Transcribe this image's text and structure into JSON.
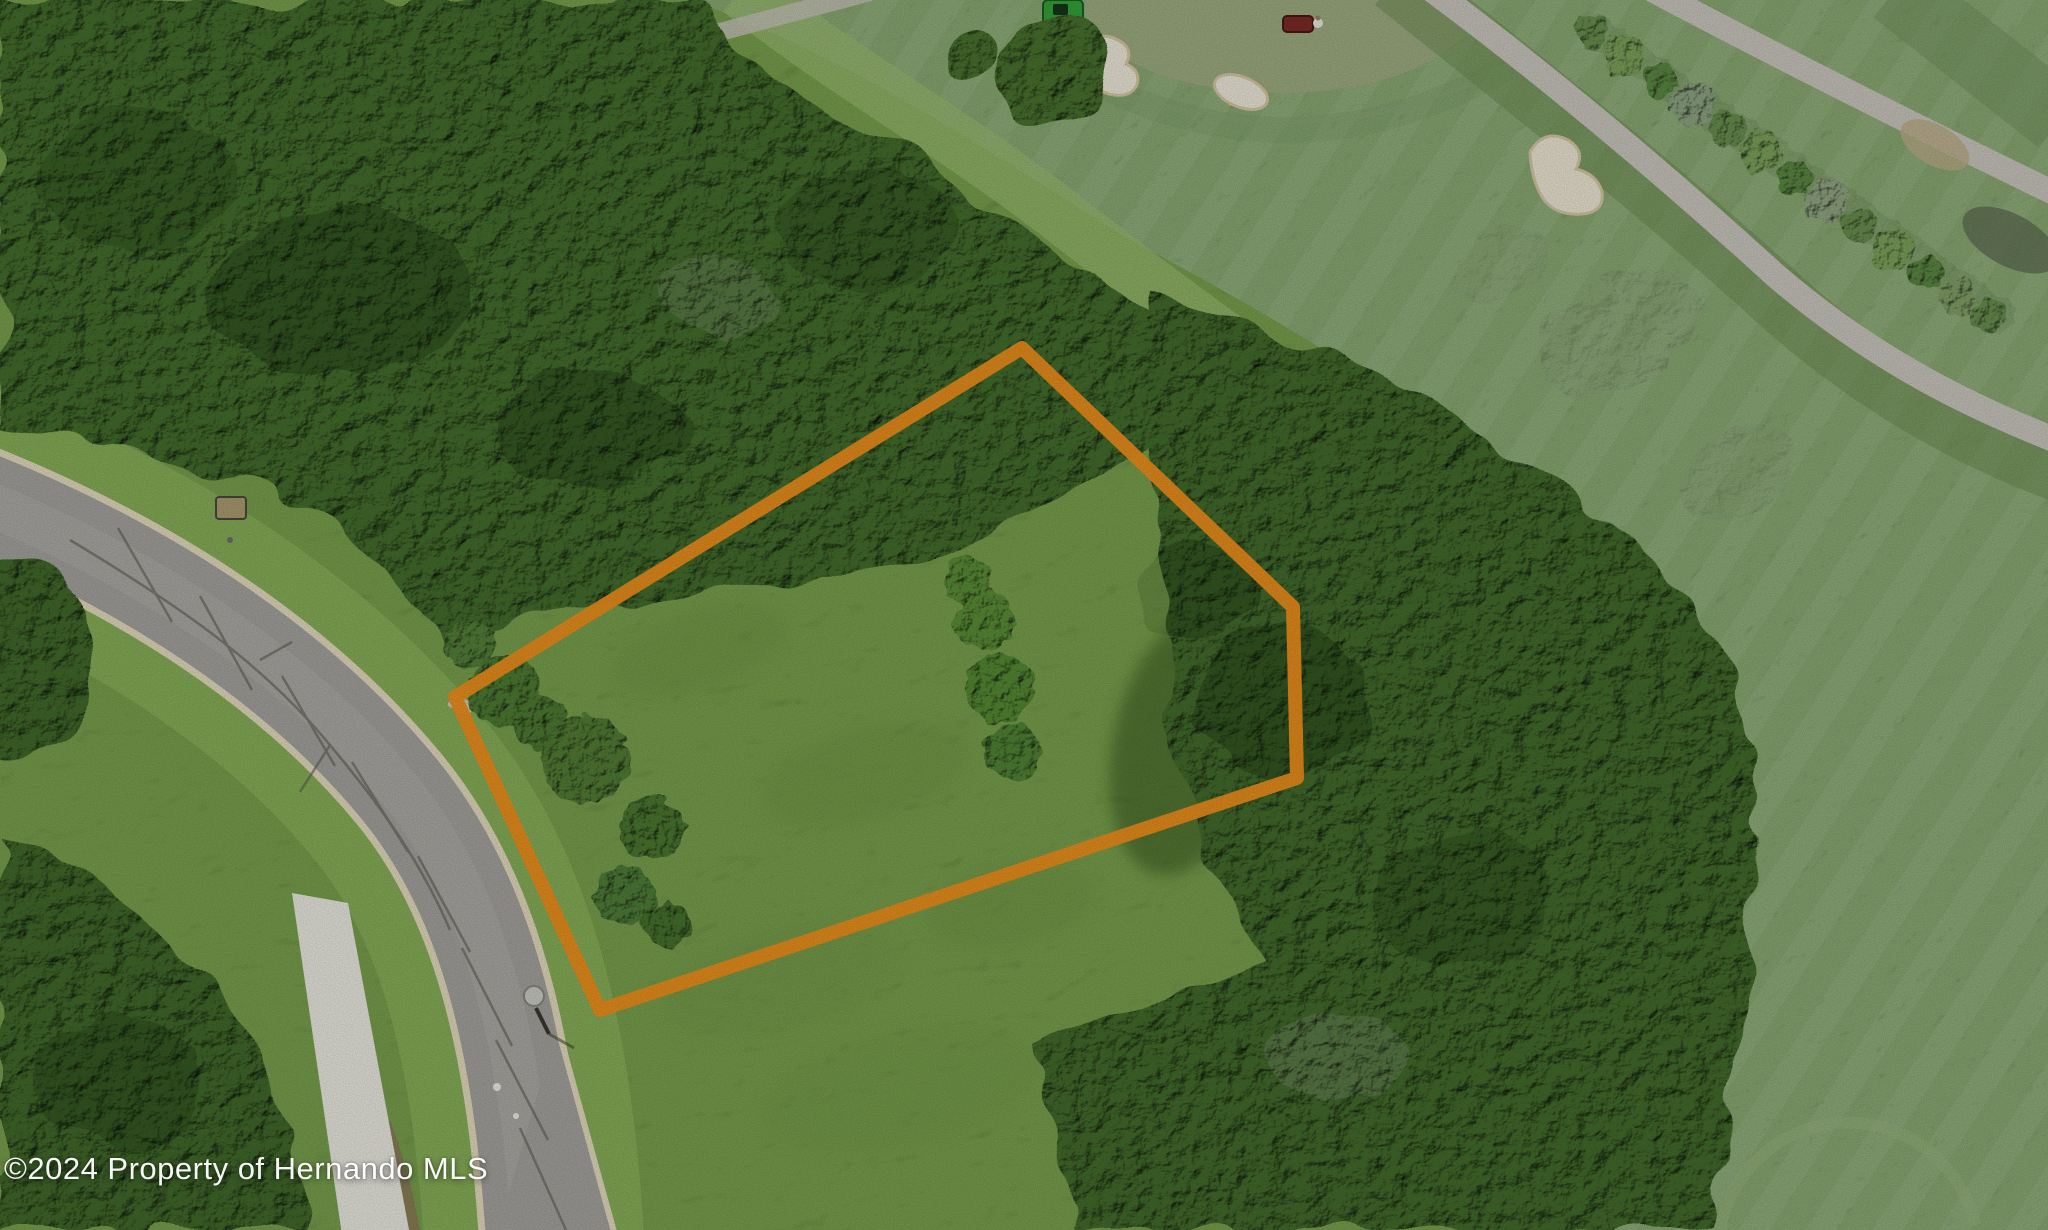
{
  "image": {
    "width": 2048,
    "height": 1230,
    "kind": "aerial-drone-photo"
  },
  "watermark": {
    "text": "©2024 Property of Hernando MLS",
    "color": "#FFFFFF"
  },
  "boundary": {
    "points": "455,697 1022,348 1293,607 1297,778 600,1010",
    "color": "#F2921D",
    "stroke_width": 14
  },
  "scene": {
    "description": "Aerial photo of a vacant wooded lot outlined in orange, beside a curved asphalt street on the left and a golf course with fairways, sand bunkers, cart paths, a hedge row and maintenance mowers on the upper right.",
    "features": [
      "vacant-lot-grass",
      "tree-stands",
      "curved-asphalt-road",
      "white-concrete-path",
      "golf-fairway",
      "putting-green",
      "sand-bunkers",
      "golf-cart-paths",
      "hedge-row",
      "green-tractor-mower",
      "red-mower-with-worker",
      "street-light",
      "utility-box"
    ]
  }
}
